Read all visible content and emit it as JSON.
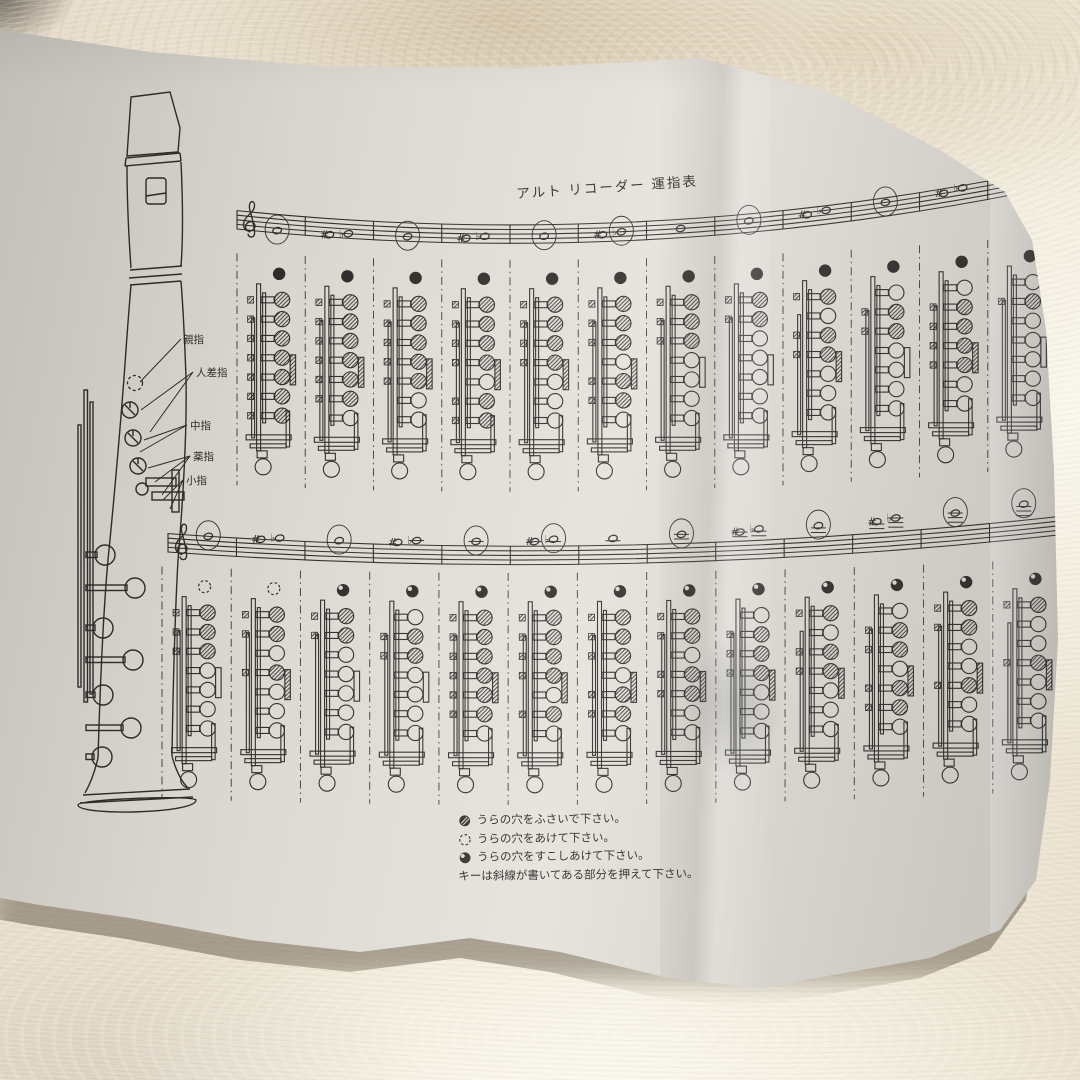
{
  "header": {
    "title": "アルト リコーダー 運指表"
  },
  "instrument": {
    "finger_labels": [
      {
        "label": "親指"
      },
      {
        "label": "人差指"
      },
      {
        "label": "中指"
      },
      {
        "label": "薬指"
      },
      {
        "label": "小指"
      }
    ]
  },
  "legend": {
    "items": [
      {
        "symbol": "back-hole-closed",
        "text": "うらの穴をふさいで下さい。"
      },
      {
        "symbol": "back-hole-open",
        "text": "うらの穴をあけて下さい。"
      },
      {
        "symbol": "back-hole-slightly-open",
        "text": "うらの穴をすこしあけて下さい。"
      }
    ],
    "key_note": "キーは斜線が書いてある部分を押えて下さい。"
  },
  "palette": {
    "ink": "#2e2c29",
    "paper": "#dbd8d1",
    "carpet": "#ece4d2",
    "carpet_tan": "#cdbb9c"
  },
  "chart_data": {
    "type": "table",
    "title": "アルト リコーダー 運指表",
    "clef": "treble",
    "hole_states": {
      "1": "closed (hatched)",
      "0": "open"
    },
    "thumb_states": [
      "closed",
      "open",
      "half"
    ],
    "rows": [
      {
        "register": "low",
        "columns": [
          {
            "notes": [
              {
                "name": "F4",
                "step": 1,
                "circled": true
              }
            ],
            "thumb": "closed",
            "holes": [
              1,
              1,
              1,
              1,
              1,
              1,
              1
            ]
          },
          {
            "notes": [
              {
                "name": "F#4",
                "step": 1,
                "acc": "#"
              },
              {
                "name": "G♭4",
                "step": 2,
                "acc": "♭"
              }
            ],
            "thumb": "closed",
            "holes": [
              1,
              1,
              1,
              1,
              1,
              1,
              0
            ]
          },
          {
            "notes": [
              {
                "name": "G4",
                "step": 2,
                "circled": true
              }
            ],
            "thumb": "closed",
            "holes": [
              1,
              1,
              1,
              1,
              1,
              0,
              0
            ]
          },
          {
            "notes": [
              {
                "name": "G#4",
                "step": 2,
                "acc": "#"
              },
              {
                "name": "A♭4",
                "step": 3,
                "acc": "♭"
              }
            ],
            "thumb": "closed",
            "holes": [
              1,
              1,
              1,
              1,
              0,
              1,
              1
            ]
          },
          {
            "notes": [
              {
                "name": "A4",
                "step": 3,
                "circled": true
              }
            ],
            "thumb": "closed",
            "holes": [
              1,
              1,
              1,
              1,
              0,
              0,
              0
            ]
          },
          {
            "notes": [
              {
                "name": "A#4",
                "step": 3,
                "acc": "#"
              },
              {
                "name": "B♭4",
                "step": 4,
                "acc": "♭",
                "circled": true
              }
            ],
            "thumb": "closed",
            "holes": [
              1,
              1,
              1,
              0,
              1,
              1,
              0
            ]
          },
          {
            "notes": [
              {
                "name": "B4",
                "step": 4
              }
            ],
            "thumb": "closed",
            "holes": [
              1,
              1,
              1,
              0,
              0,
              0,
              0
            ]
          },
          {
            "notes": [
              {
                "name": "C5",
                "step": 5,
                "circled": true
              }
            ],
            "thumb": "closed",
            "holes": [
              1,
              1,
              0,
              0,
              0,
              0,
              0
            ]
          },
          {
            "notes": [
              {
                "name": "C#5",
                "step": 5,
                "acc": "#"
              },
              {
                "name": "D♭5",
                "step": 6,
                "acc": "♭"
              }
            ],
            "thumb": "closed",
            "holes": [
              1,
              0,
              1,
              1,
              0,
              0,
              0
            ]
          },
          {
            "notes": [
              {
                "name": "D5",
                "step": 6,
                "circled": true
              }
            ],
            "thumb": "closed",
            "holes": [
              0,
              1,
              1,
              0,
              0,
              0,
              0
            ]
          },
          {
            "notes": [
              {
                "name": "D#5",
                "step": 6,
                "acc": "#"
              },
              {
                "name": "E♭5",
                "step": 7,
                "acc": "♭"
              }
            ],
            "thumb": "closed",
            "holes": [
              0,
              1,
              1,
              1,
              1,
              0,
              0
            ]
          },
          {
            "notes": [
              {
                "name": "E5",
                "step": 7,
                "circled": true
              }
            ],
            "thumb": "closed",
            "holes": [
              0,
              1,
              0,
              0,
              0,
              0,
              0
            ]
          }
        ]
      },
      {
        "register": "high",
        "columns": [
          {
            "notes": [
              {
                "name": "F5",
                "step": 8,
                "circled": true
              }
            ],
            "thumb": "open",
            "holes": [
              1,
              1,
              1,
              0,
              0,
              0,
              0
            ]
          },
          {
            "notes": [
              {
                "name": "F#5",
                "step": 8,
                "acc": "#"
              },
              {
                "name": "G♭5",
                "step": 9,
                "acc": "♭"
              }
            ],
            "thumb": "open",
            "holes": [
              1,
              1,
              0,
              1,
              0,
              0,
              0
            ]
          },
          {
            "notes": [
              {
                "name": "G5",
                "step": 9,
                "circled": true
              }
            ],
            "thumb": "half",
            "holes": [
              1,
              1,
              0,
              0,
              0,
              0,
              0
            ]
          },
          {
            "notes": [
              {
                "name": "G#5",
                "step": 9,
                "acc": "#"
              },
              {
                "name": "A♭5",
                "step": 10,
                "acc": "♭"
              }
            ],
            "thumb": "half",
            "holes": [
              0,
              1,
              1,
              0,
              0,
              0,
              0
            ]
          },
          {
            "notes": [
              {
                "name": "A5",
                "step": 10,
                "circled": true
              }
            ],
            "thumb": "half",
            "holes": [
              1,
              1,
              1,
              1,
              1,
              1,
              0
            ]
          },
          {
            "notes": [
              {
                "name": "A#5",
                "step": 10,
                "acc": "#"
              },
              {
                "name": "B♭5",
                "step": 11,
                "acc": "♭",
                "circled": true
              }
            ],
            "thumb": "half",
            "holes": [
              1,
              1,
              1,
              1,
              0,
              1,
              0
            ]
          },
          {
            "notes": [
              {
                "name": "B5",
                "step": 11
              }
            ],
            "thumb": "half",
            "holes": [
              1,
              1,
              1,
              0,
              1,
              1,
              0
            ]
          },
          {
            "notes": [
              {
                "name": "C6",
                "step": 12,
                "circled": true
              }
            ],
            "thumb": "half",
            "holes": [
              1,
              1,
              0,
              1,
              1,
              0,
              0
            ]
          },
          {
            "notes": [
              {
                "name": "C#6",
                "step": 12,
                "acc": "#"
              },
              {
                "name": "D♭6",
                "step": 13,
                "acc": "♭"
              }
            ],
            "thumb": "half",
            "holes": [
              0,
              1,
              1,
              1,
              0,
              0,
              0
            ]
          },
          {
            "notes": [
              {
                "name": "D6",
                "step": 13,
                "circled": true
              }
            ],
            "thumb": "half",
            "holes": [
              1,
              0,
              1,
              1,
              0,
              0,
              0
            ]
          },
          {
            "notes": [
              {
                "name": "D#6",
                "step": 13,
                "acc": "#"
              },
              {
                "name": "E♭6",
                "step": 14,
                "acc": "♭"
              }
            ],
            "thumb": "half",
            "holes": [
              0,
              1,
              1,
              0,
              1,
              1,
              0
            ]
          },
          {
            "notes": [
              {
                "name": "E6",
                "step": 14,
                "circled": true
              }
            ],
            "thumb": "half",
            "holes": [
              1,
              1,
              0,
              0,
              1,
              0,
              0
            ]
          },
          {
            "notes": [
              {
                "name": "F6",
                "step": 15,
                "circled": true
              }
            ],
            "thumb": "half",
            "holes": [
              1,
              0,
              0,
              1,
              0,
              0,
              0
            ]
          }
        ]
      }
    ]
  }
}
